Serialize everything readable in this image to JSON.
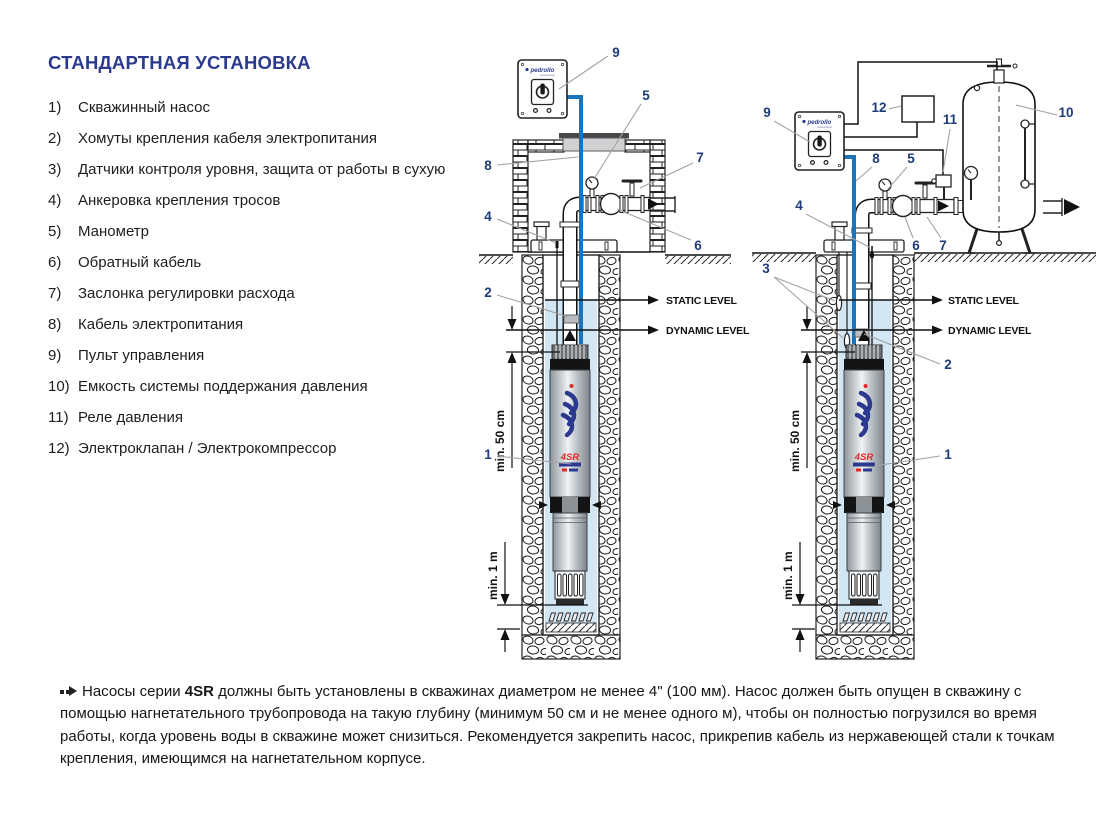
{
  "page": {
    "title": "СТАНДАРТНАЯ УСТАНОВКА"
  },
  "legend": {
    "items": [
      {
        "num": "1)",
        "label": "Скважинный насос"
      },
      {
        "num": "2)",
        "label": "Хомуты крепления кабеля электропитания"
      },
      {
        "num": "3)",
        "label": "Датчики контроля уровня, защита от работы в сухую"
      },
      {
        "num": "4)",
        "label": "Анкеровка крепления тросов"
      },
      {
        "num": "5)",
        "label": "Манометр"
      },
      {
        "num": "6)",
        "label": "Обратный кабель"
      },
      {
        "num": "7)",
        "label": "Заслонка регулировки расхода"
      },
      {
        "num": "8)",
        "label": "Кабель электропитания"
      },
      {
        "num": "9)",
        "label": "Пульт управления"
      },
      {
        "num": "10)",
        "label": "Емкость системы поддержания давления"
      },
      {
        "num": "11)",
        "label": "Реле давления"
      },
      {
        "num": "12)",
        "label": "Электроклапан / Электрокомпрессор"
      }
    ]
  },
  "diagram": {
    "callouts": {
      "c1": "1",
      "c2": "2",
      "c3": "3",
      "c4": "4",
      "c5": "5",
      "c6": "6",
      "c7": "7",
      "c8": "8",
      "c9": "9",
      "c10": "10",
      "c11": "11",
      "c12": "12"
    },
    "static_level": "STATIC LEVEL",
    "dynamic_level": "DYNAMIC LEVEL",
    "min_submersion": "min. 50 cm",
    "min_bottom": "min. 1 m",
    "brand": "pedrollo",
    "pump_model": "4SR"
  },
  "note": {
    "lead": "Насосы серии ",
    "bold": "4SR",
    "rest": " должны быть установлены в скважинах диаметром не менее 4\" (100 мм). Насос должен быть опущен в скважину с помощью нагнетательного трубопровода на такую глубину (минимум 50 см и не менее одного м), чтобы он полностью погрузился во время работы, когда уровень воды в скважине может снизиться. Рекомендуется закрепить насос, прикрепив кабель из нержавеющей стали к точкам крепления, имеющимся на нагнетательном корпусе."
  },
  "colors": {
    "title_navy": "#2b3a8f",
    "callout_navy": "#1e3c78",
    "cable_blue": "#1b74ba",
    "water_blue": "#d2e6f4",
    "logo_navy": "#2b3a8f",
    "logo_red": "#e02826",
    "lid_gray": "#d0d1d3"
  }
}
